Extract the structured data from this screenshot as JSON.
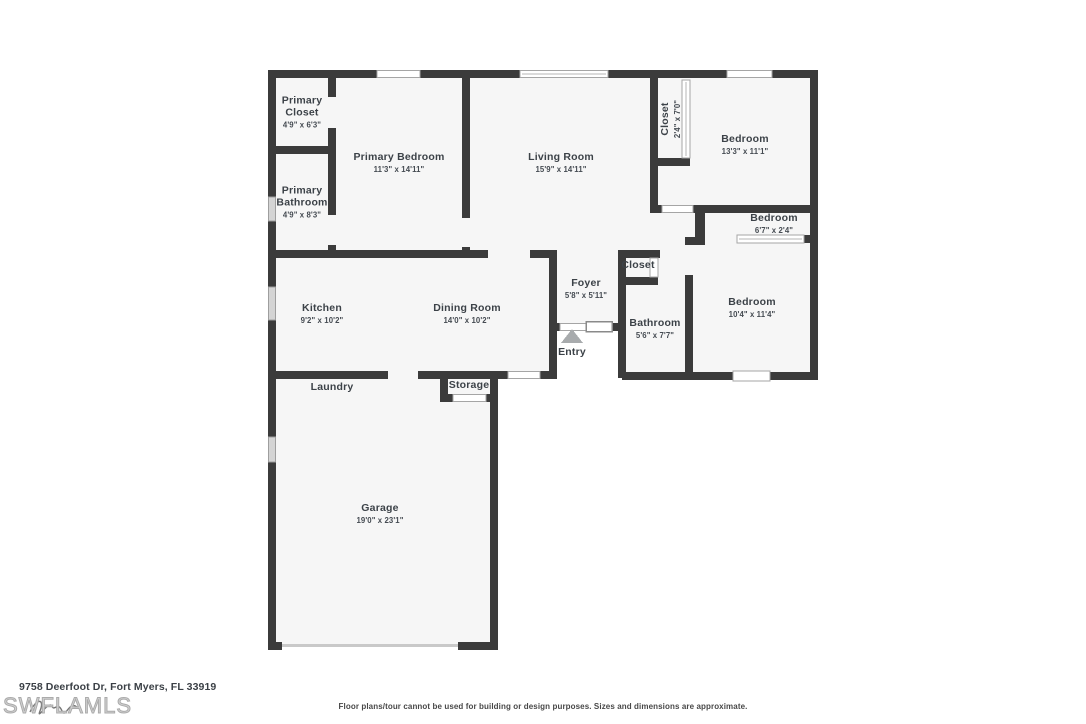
{
  "floorplan": {
    "rooms": [
      {
        "name": "Primary Closet",
        "dims": "4'9\" x 6'3\""
      },
      {
        "name": "Primary Bedroom",
        "dims": "11'3\" x 14'11\""
      },
      {
        "name": "Primary Bathroom",
        "dims": "4'9\" x 8'3\""
      },
      {
        "name": "Living Room",
        "dims": "15'9\" x 14'11\""
      },
      {
        "name": "Closet",
        "dims": "2'4\" x 7'0\""
      },
      {
        "name": "Bedroom",
        "dims": "13'3\" x 11'1\""
      },
      {
        "name": "Bedroom",
        "dims": "6'7\" x 2'4\""
      },
      {
        "name": "Kitchen",
        "dims": "9'2\" x 10'2\""
      },
      {
        "name": "Dining Room",
        "dims": "14'0\" x 10'2\""
      },
      {
        "name": "Foyer",
        "dims": "5'8\" x 5'11\""
      },
      {
        "name": "Closet",
        "dims": ""
      },
      {
        "name": "Bathroom",
        "dims": "5'6\" x 7'7\""
      },
      {
        "name": "Bedroom",
        "dims": "10'4\" x 11'4\""
      },
      {
        "name": "Laundry",
        "dims": ""
      },
      {
        "name": "Storage",
        "dims": ""
      },
      {
        "name": "Garage",
        "dims": "19'0\" x 23'1\""
      },
      {
        "name": "Entry",
        "dims": ""
      }
    ]
  },
  "footer": {
    "address": "9758 Deerfoot Dr, Fort Myers, FL 33919",
    "watermark": "SWFLAMLS",
    "disclaimer": "Floor plans/tour cannot be used for building or design purposes. Sizes and dimensions are approximate."
  },
  "colors": {
    "wall": "#3b3b3b",
    "floor": "#f6f6f6",
    "label_text": "#3c4248",
    "window_gray": "#d4d4d4",
    "window_outline": "#a5a5a5"
  }
}
